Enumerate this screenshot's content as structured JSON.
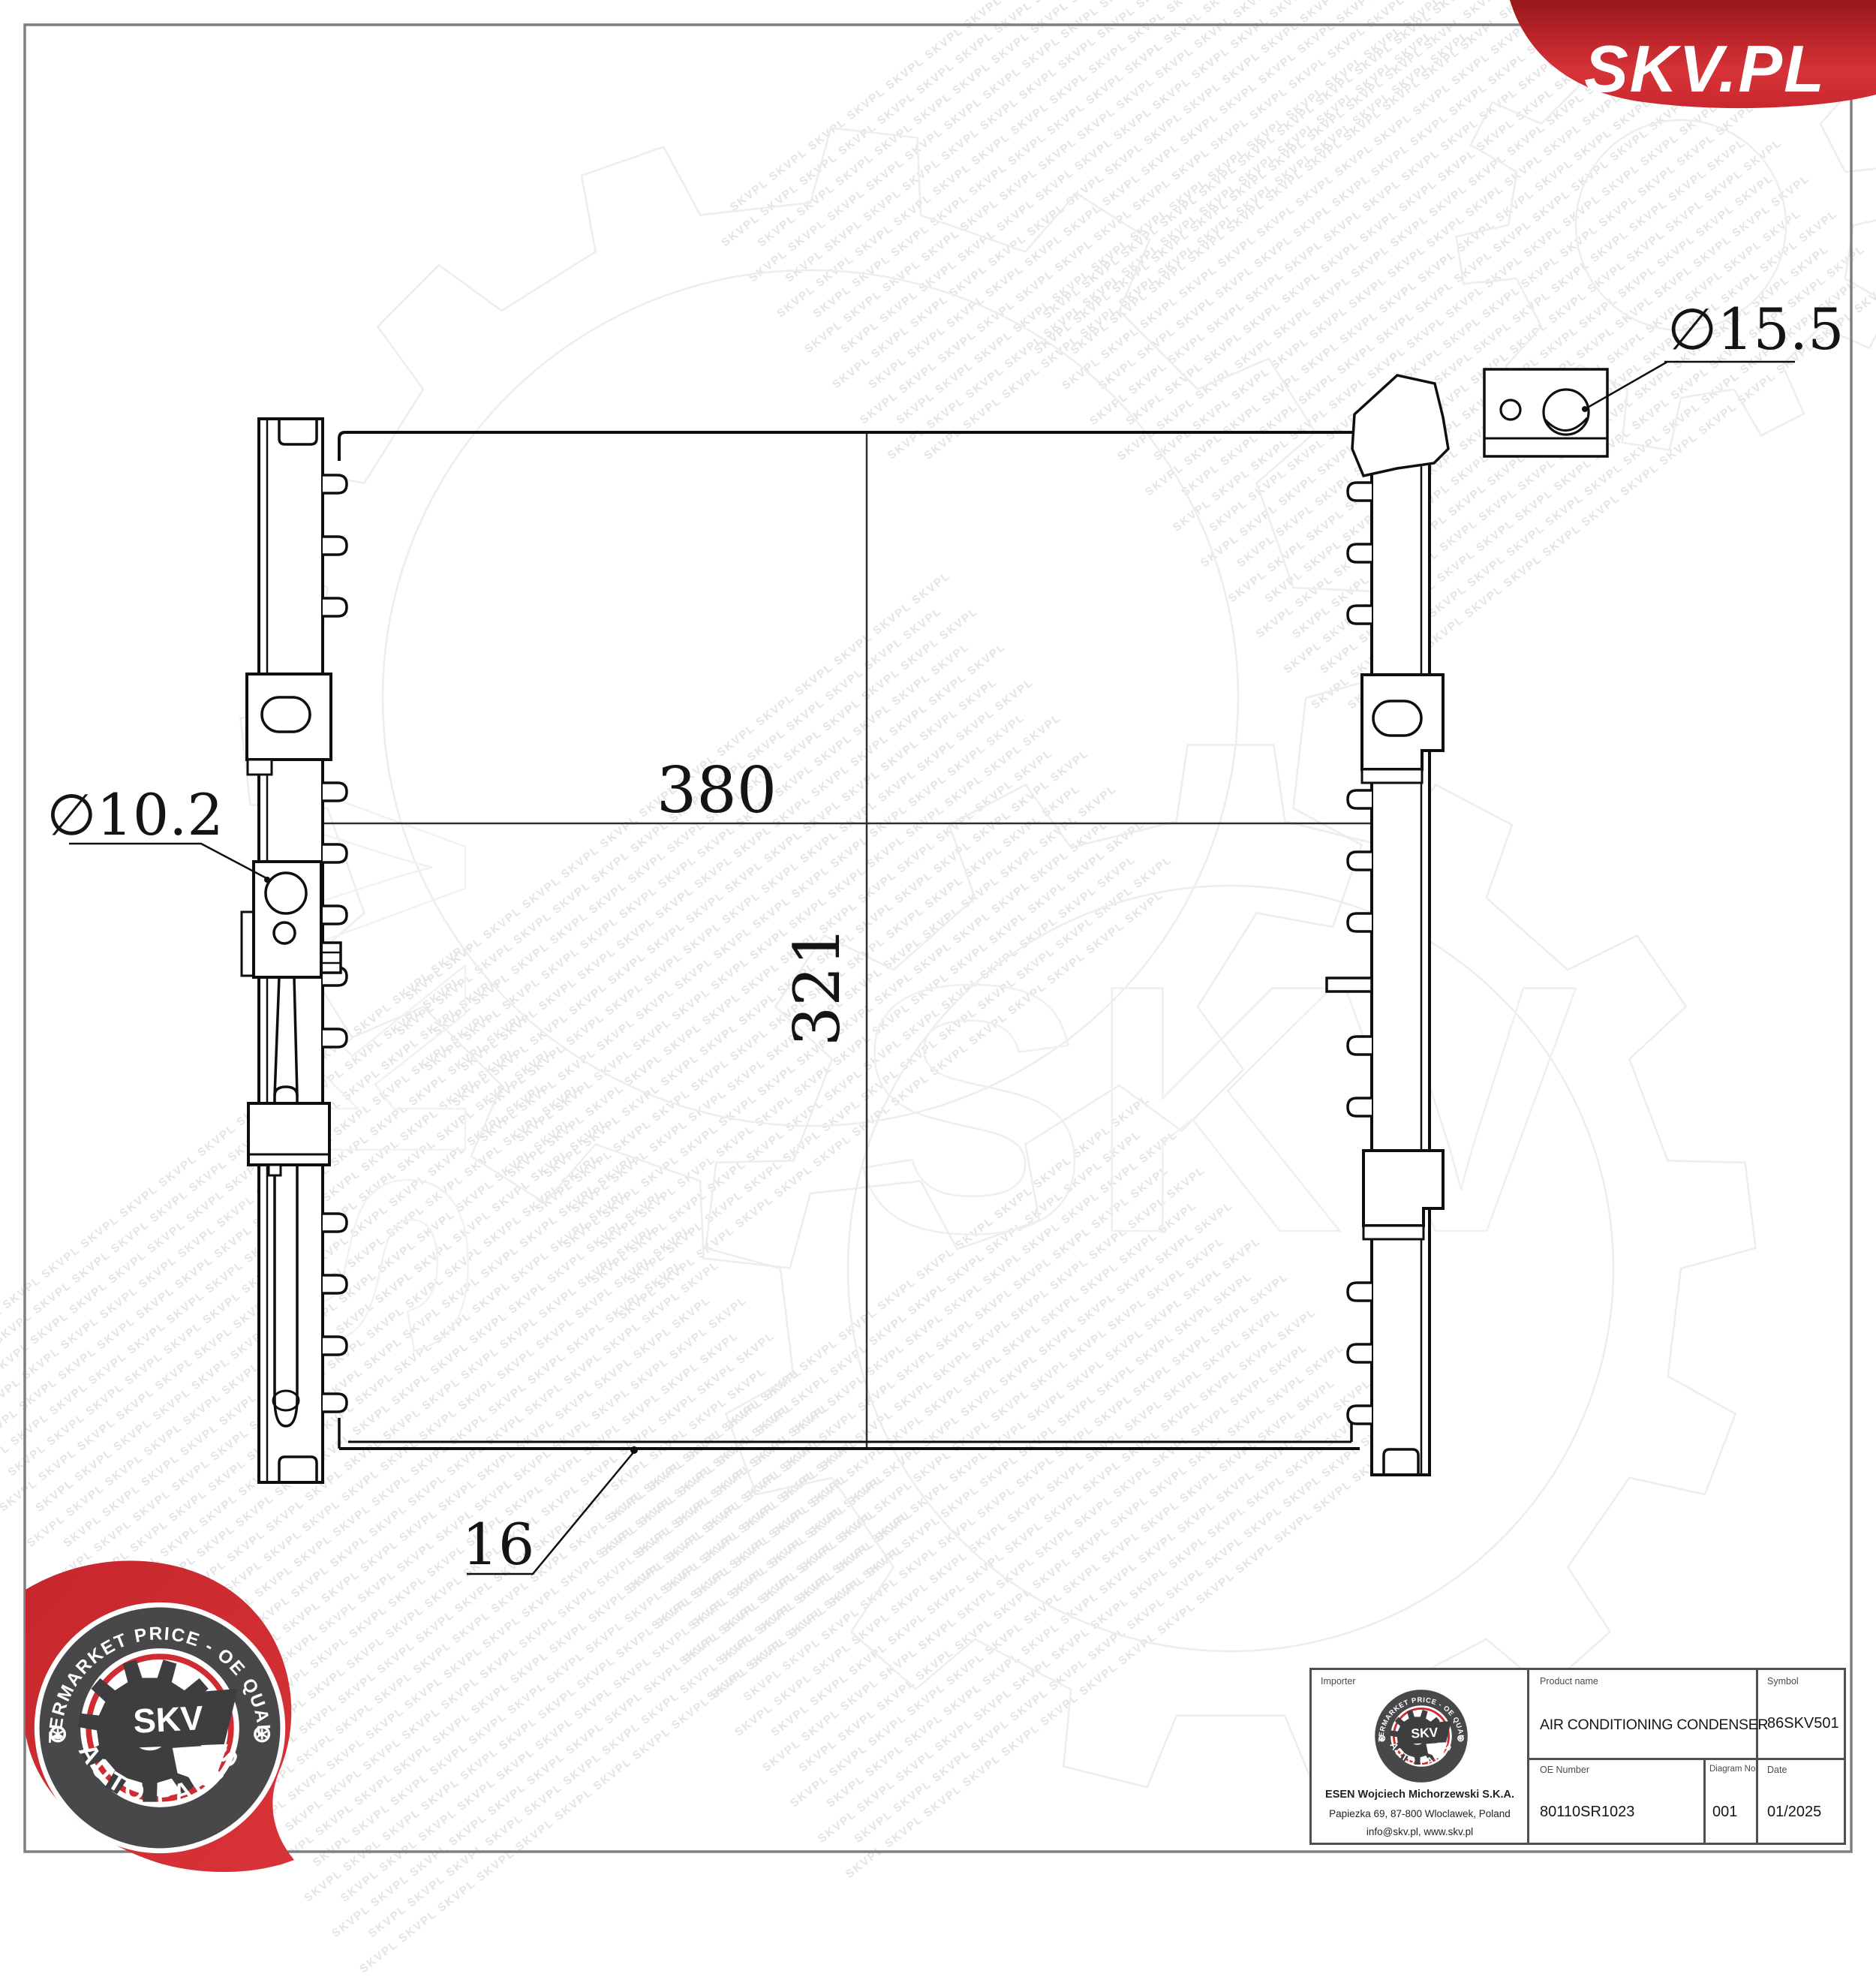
{
  "brand": {
    "banner_text": "SKV.PL",
    "red_dark": "#97181d",
    "red_mid": "#d63338",
    "red_deep": "#c8292e"
  },
  "logo": {
    "ring_text_top": "AFTERMARKET PRICE - OE QUALITY",
    "ring_text_bottom": "AUTO PARTS",
    "center_text": "SKV",
    "star": "⊛",
    "dark": "#48484a",
    "red": "#cf2b30"
  },
  "watermark": {
    "token": "SKVPL",
    "ghost_text": "SKV"
  },
  "drawing": {
    "dims": {
      "width_label": "380",
      "height_label": "321",
      "thickness_label": "16",
      "hole_left": "∅10.2",
      "hole_right": "∅15.5"
    }
  },
  "title_block": {
    "importer": {
      "label": "Importer",
      "company": "ESEN Wojciech Michorzewski S.K.A.",
      "address": "Papiezka 69, 87-800 Wloclawek, Poland",
      "contact": "info@skv.pl, www.skv.pl"
    },
    "product": {
      "label": "Product name",
      "value": "AIR CONDITIONING CONDENSER"
    },
    "symbol": {
      "label": "Symbol",
      "value": "86SKV501"
    },
    "oe": {
      "label": "OE Number",
      "value": "80110SR1023"
    },
    "diagram": {
      "label": "Diagram No",
      "value": "001"
    },
    "date": {
      "label": "Date",
      "value": "01/2025"
    }
  }
}
